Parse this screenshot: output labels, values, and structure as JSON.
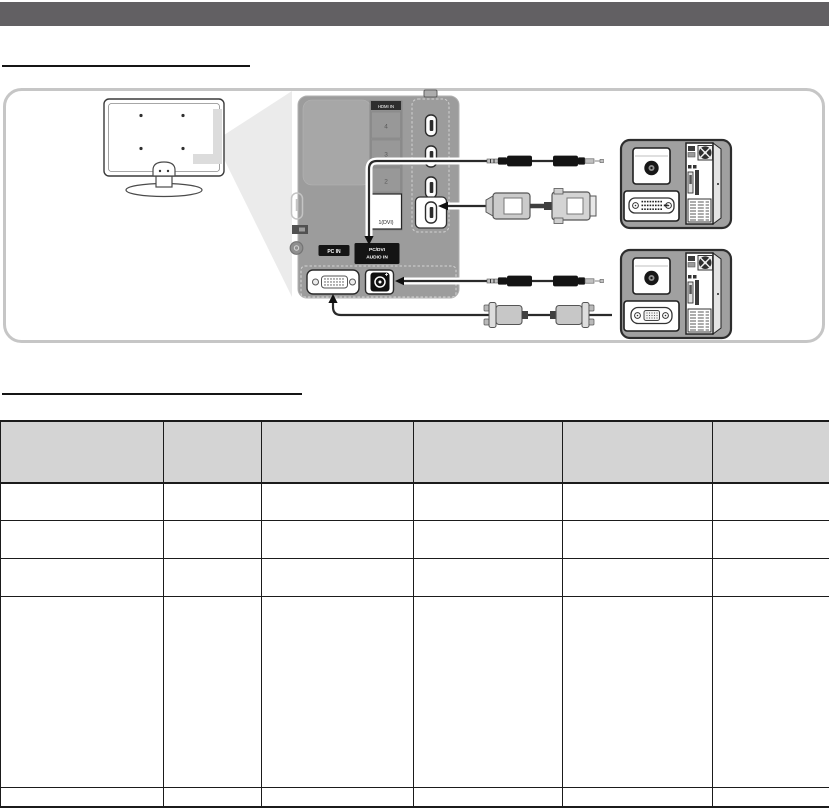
{
  "colors": {
    "top_bar": "#626063",
    "diagram_frame_border": "#c6c6c6",
    "panel_gray": "#9c9c9c",
    "callout_wedge": "#ebebeb",
    "label_black": "#141414",
    "table_header_bg": "#d4d4d4",
    "table_border": "#1b1b1b"
  },
  "diagram": {
    "panel_labels": {
      "hdmi_in": "HDMI IN",
      "hdmi_port_4": "4",
      "hdmi_port_3": "3",
      "hdmi_port_2": "2",
      "hdmi_port_1": "1(DVI)",
      "pc_in": "PC IN",
      "pc_dvi_audio_line1": "PC/DVI",
      "pc_dvi_audio_line2": "AUDIO IN"
    },
    "icons": [
      "audio-cable-icon",
      "hdmi-dvi-cable-icon",
      "d-sub-cable-icon",
      "tv-rear-icon",
      "pc-tower-rear-icon",
      "audio-out-port-icon",
      "dvi-out-port-icon",
      "vga-out-port-icon"
    ]
  },
  "table": {
    "columns": [
      "",
      "",
      "",
      "",
      "",
      ""
    ],
    "rows": [
      [
        "",
        "",
        "",
        "",
        "",
        ""
      ],
      [
        "",
        "",
        "",
        "",
        "",
        ""
      ],
      [
        "",
        "",
        "",
        "",
        "",
        ""
      ],
      [
        "",
        "",
        "",
        "",
        "",
        ""
      ],
      [
        "",
        "",
        "",
        "",
        "",
        ""
      ]
    ]
  }
}
